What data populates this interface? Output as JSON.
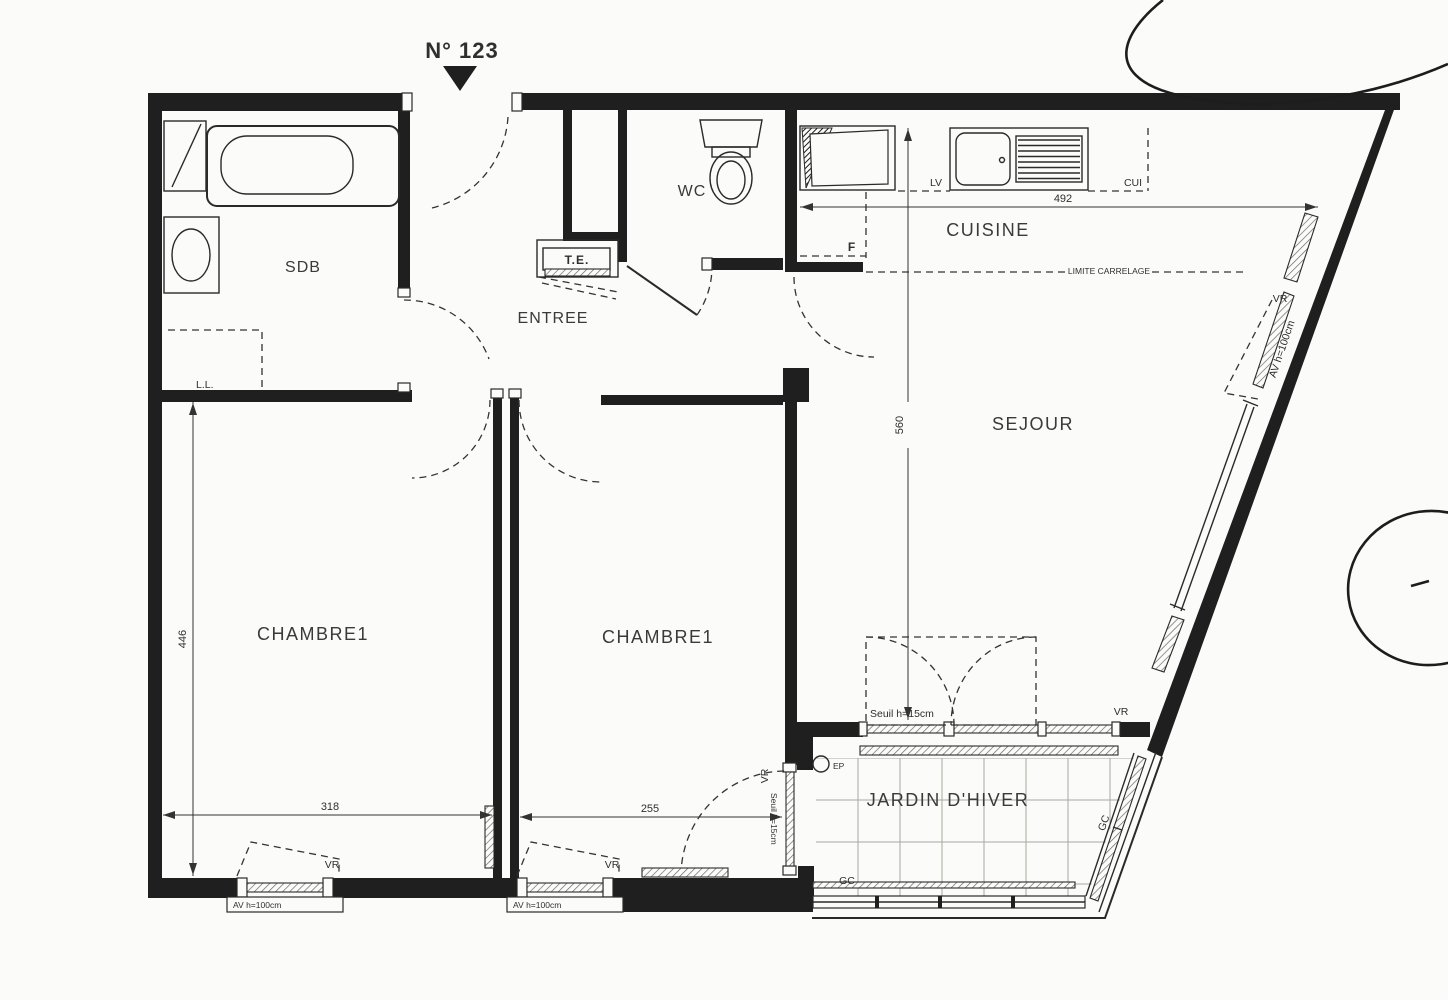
{
  "plan": {
    "unit_number": "N° 123",
    "colors": {
      "ink": "#1f1f1f",
      "paper": "#fbfbf9"
    },
    "rooms": {
      "sdb": "SDB",
      "entree": "ENTREE",
      "wc": "WC",
      "cuisine": "CUISINE",
      "sejour": "SEJOUR",
      "chambre1": "CHAMBRE1",
      "chambre2": "CHAMBRE1",
      "jardin": "JARDIN D'HIVER"
    },
    "dimensions_cm": {
      "cuisine_width": "492",
      "sejour_depth": "560",
      "chambre1_depth": "446",
      "chambre1_width": "318",
      "chambre2_width": "255"
    },
    "annotations": {
      "tableau_electrique": "T.E.",
      "lave_linge": "L.L.",
      "lave_vaisselle": "LV",
      "cuisine_plan": "CUI",
      "frigo": "F",
      "ep": "EP",
      "gc": "GC",
      "vr": "VR",
      "allege": "AV h=100cm",
      "seuil": "Seuil h=15cm",
      "limite_carrelage": "LIMITE CARRELAGE"
    }
  }
}
